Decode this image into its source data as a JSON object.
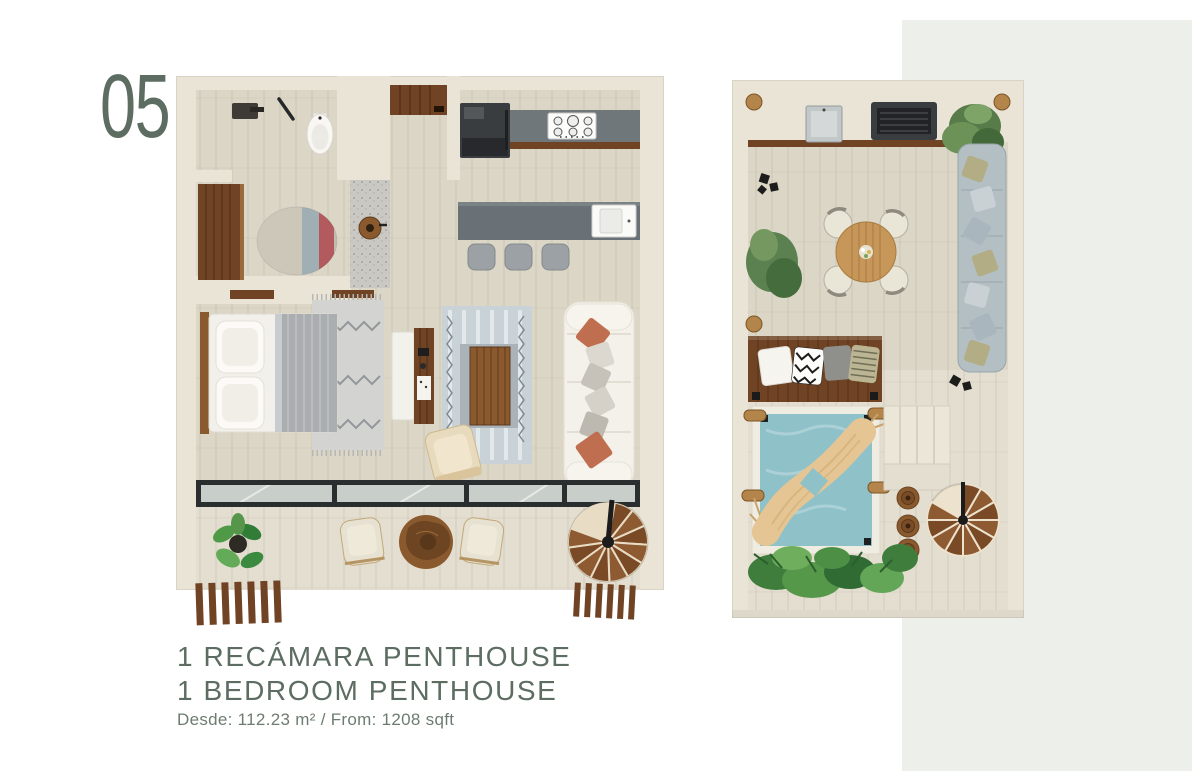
{
  "page": {
    "unit_number": "05",
    "title_es": "1 RECÁMARA PENTHOUSE",
    "title_en": "1 BEDROOM PENTHOUSE",
    "area_text": "Desde: 112.23 m² / From: 1208 sqft"
  },
  "colors": {
    "page_bg": "#ffffff",
    "panel_bg": "#edf0ea",
    "text_accent": "#5d6d62",
    "text_subtle": "#6d7c71",
    "wall": "#eae4d6",
    "floor": "#dcd6c7",
    "floor_terrace": "#e3ded0",
    "wood_dark": "#6f4323",
    "wood_mid": "#8a5a2e",
    "wood_light": "#c69758",
    "appliance": "#3a3d40",
    "counter": "#70777b",
    "island": "#697176",
    "stool": "#9ba1a4",
    "sofa": "#f4f1ea",
    "terracotta": "#bf6f50",
    "rug_blue": "#c9d2d6",
    "blanket": "#abaeb1",
    "pool": "#8fc1c9",
    "sectional": "#b4bfc4",
    "glass_frame": "#2b2e2f",
    "hammock": "#e5c593",
    "plant": "#55964a"
  }
}
